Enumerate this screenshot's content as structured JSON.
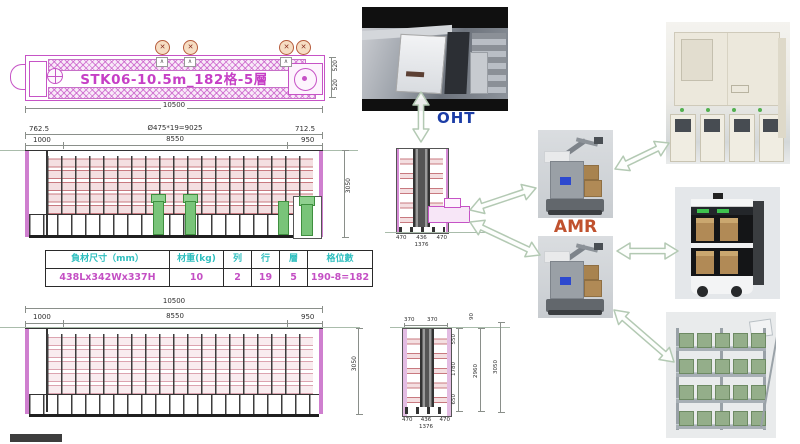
{
  "plan_view": {
    "title": "STK06-10.5m_182格-5層",
    "dims": {
      "total": "10500",
      "right_a": "520",
      "right_b": "520"
    }
  },
  "front_view": {
    "dims": {
      "offset_left": "762.5",
      "pitch": "Ø475*19=9025",
      "offset_right": "712.5",
      "left": "1000",
      "center": "8550",
      "right": "950",
      "height": "3050"
    }
  },
  "spec_table": {
    "headers": [
      "負材尺寸（mm）",
      "材重(kg)",
      "列",
      "行",
      "層",
      "格位數"
    ],
    "values": [
      "438Lx342Wx337H",
      "10",
      "2",
      "19",
      "5",
      "190-8=182"
    ]
  },
  "bottom_view": {
    "dims": {
      "total": "10500",
      "left": "1000",
      "center": "8550",
      "right": "950",
      "height": "3050"
    }
  },
  "section_upper": {
    "dims": {
      "a": "470",
      "b": "436",
      "c": "470",
      "total": "1376"
    }
  },
  "section_lower": {
    "dims": {
      "top_a": "370",
      "top_b": "370",
      "gap": "90",
      "seg_a": "550",
      "seg_b": "1780",
      "seg_c": "650",
      "inner_total": "2960",
      "outer_total": "3050",
      "a": "470",
      "b": "436",
      "c": "470",
      "total": "1376"
    }
  },
  "labels": {
    "oht": "OHT",
    "amr": "AMR"
  },
  "icons": {
    "fan_cross": "✕",
    "vent": "∧"
  },
  "colors": {
    "cad_magenta": "#c653c6",
    "shelf_red": "#c8797f",
    "lift_green": "#79c479",
    "table_header": "#2fbfbf",
    "table_value": "#c44fc4",
    "oht_label": "#1c3da6",
    "amr_label": "#c0512e",
    "arrow_stroke": "#b3c9b3"
  }
}
